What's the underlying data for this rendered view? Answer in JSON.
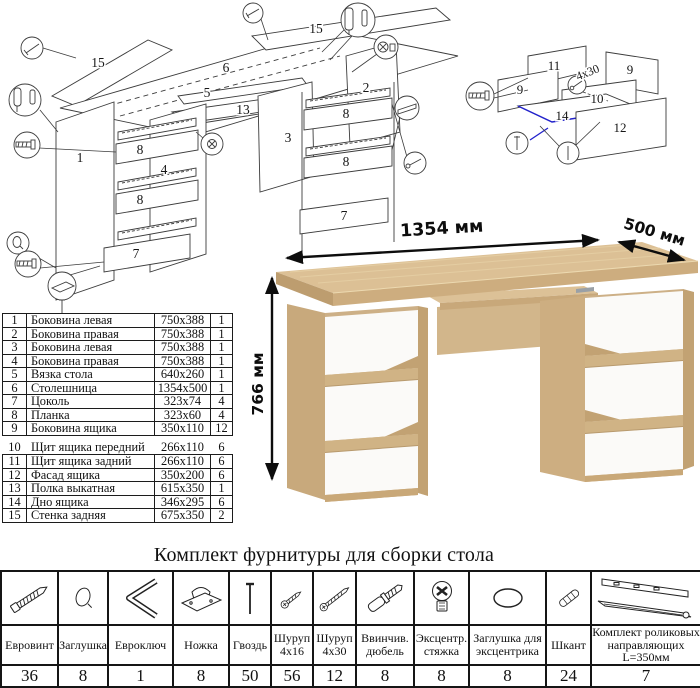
{
  "theme": {
    "oak": "#d8bc92",
    "oak-dark": "#c3a478",
    "oak-edge": "#bd9d6f",
    "drawer-white": "#fbfaf8",
    "line": "#3c3c3c",
    "blue": "#2222cc",
    "dim": "#0d0d0d"
  },
  "diagram_main": {
    "labels": [
      "15",
      "15",
      "6",
      "5",
      "13",
      "2",
      "3",
      "1",
      "8",
      "4",
      "8",
      "7",
      "8",
      "8",
      "7"
    ]
  },
  "diagram_drawer": {
    "labels": [
      "11",
      "9",
      "9",
      "10",
      "14",
      "12"
    ],
    "note": "4x30"
  },
  "product": {
    "width_label": "1354 мм",
    "depth_label": "500 мм",
    "height_label": "766 мм"
  },
  "parts_table": {
    "rows": [
      {
        "n": "1",
        "name": "Боковина левая",
        "size": "750x388",
        "qty": "1"
      },
      {
        "n": "2",
        "name": "Боковина правая",
        "size": "750x388",
        "qty": "1"
      },
      {
        "n": "3",
        "name": "Боковина левая",
        "size": "750x388",
        "qty": "1"
      },
      {
        "n": "4",
        "name": "Боковина правая",
        "size": "750x388",
        "qty": "1"
      },
      {
        "n": "5",
        "name": "Вязка стола",
        "size": "640x260",
        "qty": "1"
      },
      {
        "n": "6",
        "name": "Столешница",
        "size": "1354x500",
        "qty": "1"
      },
      {
        "n": "7",
        "name": "Цоколь",
        "size": "323x74",
        "qty": "4"
      },
      {
        "n": "8",
        "name": "Планка",
        "size": "323x60",
        "qty": "4"
      },
      {
        "n": "9",
        "name": "Боковина ящика",
        "size": "350x110",
        "qty": "12"
      },
      {
        "n": "10",
        "name": "Щит ящика передний",
        "size": "266x110",
        "qty": "6"
      },
      {
        "n": "11",
        "name": "Щит ящика задний",
        "size": "266x110",
        "qty": "6"
      },
      {
        "n": "12",
        "name": "Фасад ящика",
        "size": "350x200",
        "qty": "6"
      },
      {
        "n": "13",
        "name": "Полка выкатная",
        "size": "615x350",
        "qty": "1"
      },
      {
        "n": "14",
        "name": "Дно ящика",
        "size": "346x295",
        "qty": "6"
      },
      {
        "n": "15",
        "name": "Стенка задняя",
        "size": "675x350",
        "qty": "2"
      }
    ]
  },
  "hardware": {
    "title": "Комплект фурнитуры для сборки стола",
    "items": [
      {
        "icon": "confirmat-screw-icon",
        "line1": "Евровинт",
        "line2": "",
        "qty": "36"
      },
      {
        "icon": "plug-icon",
        "line1": "Заглушка",
        "line2": "",
        "qty": "8"
      },
      {
        "icon": "hex-key-icon",
        "line1": "Евроключ",
        "line2": "",
        "qty": "1"
      },
      {
        "icon": "foot-icon",
        "line1": "Ножка",
        "line2": "",
        "qty": "8"
      },
      {
        "icon": "nail-icon",
        "line1": "Гвоздь",
        "line2": "",
        "qty": "50"
      },
      {
        "icon": "screw-icon",
        "line1": "Шуруп",
        "line2": "4x16",
        "qty": "56"
      },
      {
        "icon": "screw-icon",
        "line1": "Шуруп",
        "line2": "4x30",
        "qty": "12"
      },
      {
        "icon": "dowel-screw-icon",
        "line1": "Ввинчив.",
        "line2": "дюбель",
        "qty": "8"
      },
      {
        "icon": "cam-lock-icon",
        "line1": "Эксцентр.",
        "line2": "стяжка",
        "qty": "8"
      },
      {
        "icon": "cam-cap-icon",
        "line1": "Заглушка для",
        "line2": "эксцентрика",
        "qty": "8"
      },
      {
        "icon": "wood-dowel-icon",
        "line1": "Шкант",
        "line2": "",
        "qty": "24"
      },
      {
        "icon": "drawer-slides-icon",
        "line1": "Комплект роликовых",
        "line2": "направляющих L=350мм",
        "qty": "7"
      }
    ]
  }
}
